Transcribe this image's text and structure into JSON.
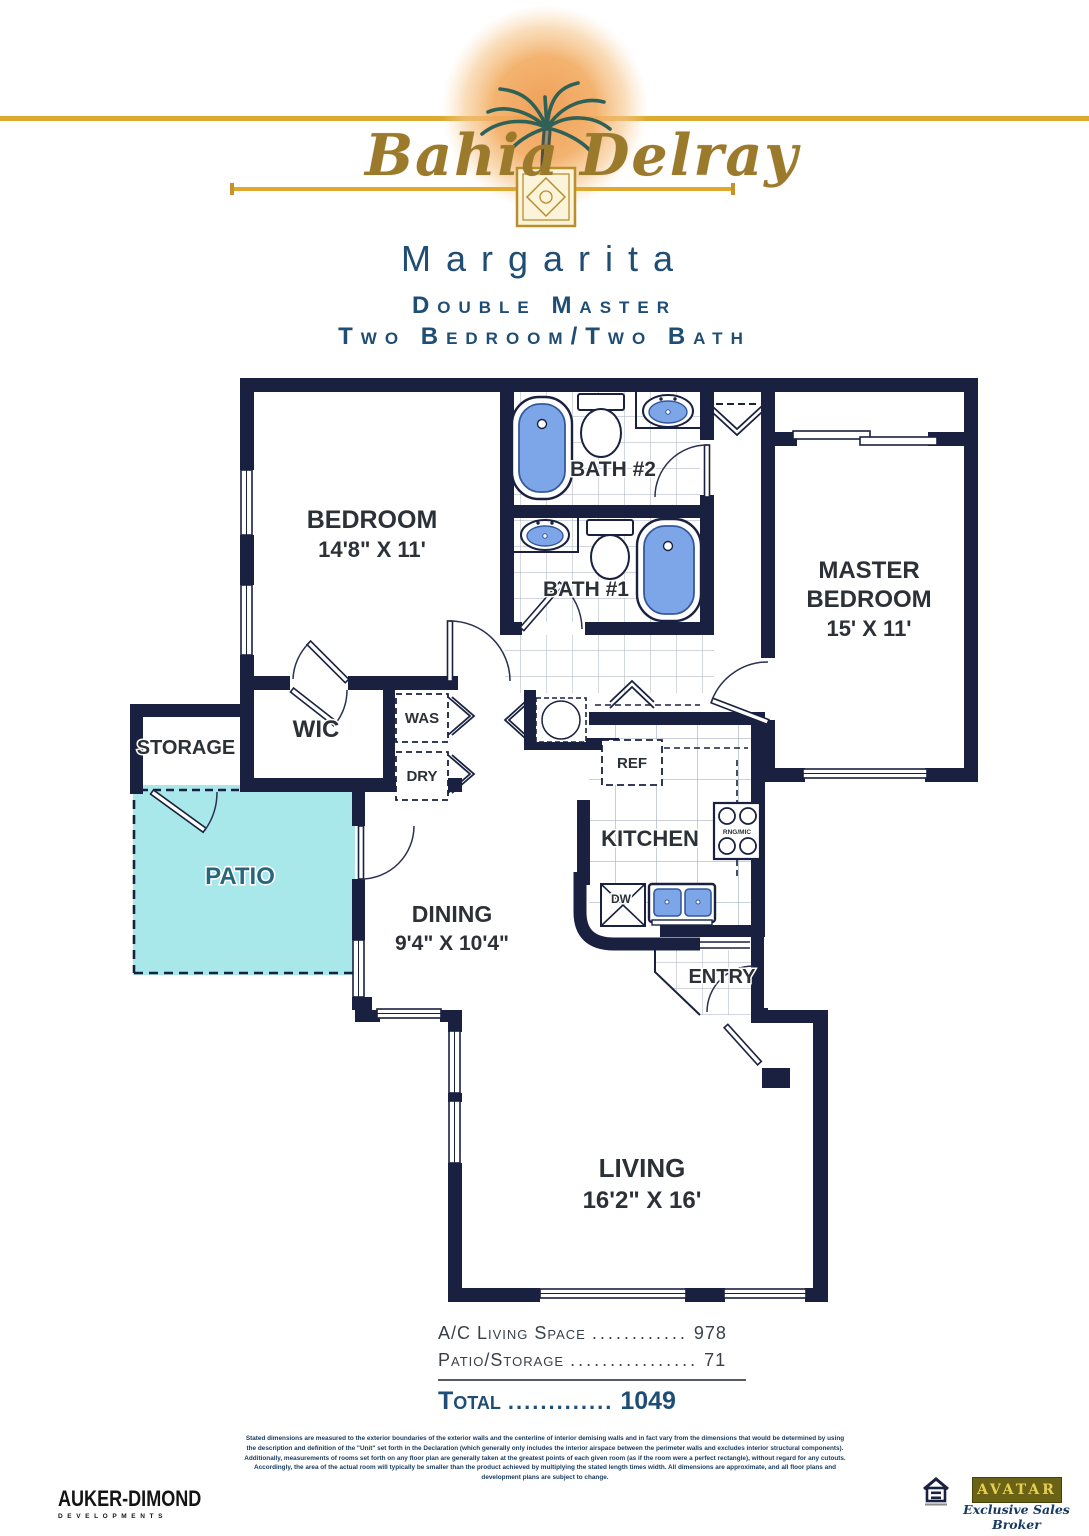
{
  "header": {
    "brand_first": "Bahia",
    "brand_second": "Delray",
    "plan_name": "Margarita",
    "subtitle_line1": "Double Master",
    "subtitle_line2": "Two Bedroom/Two Bath"
  },
  "plan": {
    "bedroom_name": "BEDROOM",
    "bedroom_dims": "14'8\" X 11'",
    "bath2": "BATH #2",
    "bath1": "BATH #1",
    "master_line1": "MASTER",
    "master_line2": "BEDROOM",
    "master_dims": "15' X 11'",
    "wic": "WIC",
    "storage": "STORAGE",
    "patio": "PATIO",
    "dining_name": "DINING",
    "dining_dims": "9'4\" X 10'4\"",
    "kitchen": "KITCHEN",
    "entry": "ENTRY",
    "living_name": "LIVING",
    "living_dims": "16'2\" X 16'",
    "washer": "WAS",
    "dryer": "DRY",
    "fridge": "REF",
    "dishwasher": "DW",
    "range_micro": "RNG/MIC"
  },
  "areas": {
    "rows": [
      {
        "label": "A/C Living Space",
        "dots": "............",
        "value": "978"
      },
      {
        "label": "Patio/Storage",
        "dots": "................",
        "value": "71"
      }
    ],
    "total": {
      "label": "Total",
      "dots": ".............",
      "value": "1049"
    }
  },
  "disclaimer": "Stated dimensions are measured to the exterior boundaries of the exterior walls and the centerline of interior demising walls and in fact vary from the dimensions that would be determined by using the description and definition of the \"Unit\" set forth in the Declaration (which generally only includes the interior airspace between the perimeter walls and excludes interior structural components).  Additionally, measurements of rooms set forth on any floor plan are generally taken at the greatest points of each given room (as if the room were a perfect rectangle), without regard for any cutouts.  Accordingly, the area of the actual room will typically be smaller than the product achieved by multiplying the stated length times width. All dimensions are approximate, and all floor plans and development plans are subject to change.",
  "footer": {
    "developer_name": "AUKER-DIMOND",
    "developer_sub": "DEVELOPMENTS",
    "broker_logo": "AVATAR",
    "broker_tagline": "Exclusive Sales Broker"
  },
  "colors": {
    "wall_navy": "#1a2140",
    "fixture_blue": "#7da6e8",
    "patio_fill": "#a9e8ea",
    "accent_blue": "#1f4d74",
    "gold": "#dfa92f"
  }
}
